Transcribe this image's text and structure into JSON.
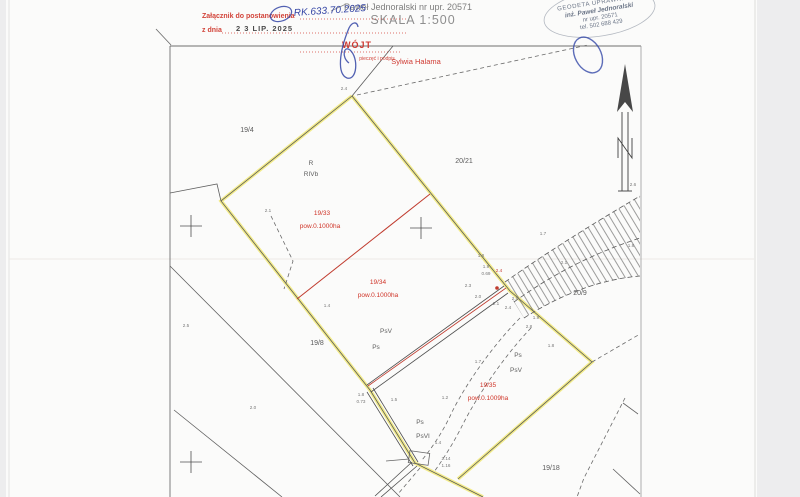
{
  "header": {
    "surveyor_line": "Paweł Jednoralski nr upr. 20571",
    "scale": "SKALA 1:500"
  },
  "attachment_stamp": {
    "line1": "Załącznik do postanowienia",
    "case_number": "RK.633.70.2025",
    "date_label": "z dnia",
    "date_stamp": "2 3  LIP. 2025",
    "caption": "pieczęć i podpis"
  },
  "mayor_stamp": {
    "title": "WÓJT",
    "name": "Sylwia Halama"
  },
  "surveyor_stamp": {
    "line1": "GEODETA UPRAWNIONY",
    "line2": "inż. Paweł Jednoralski",
    "line3": "nr upr.  20571",
    "line4": "tel. 502 688 429"
  },
  "colors": {
    "boundary_highlight": "#f1e97c",
    "split_line_red": "#c03b2e",
    "stamp_red": "#d2443a",
    "pen_blue": "#3445a5",
    "surveyor_stamp_gray": "#6b7587"
  },
  "map": {
    "parcel_labels": [
      {
        "t": "19/4",
        "x": 247,
        "y": 132
      },
      {
        "t": "20/21",
        "x": 464,
        "y": 163
      },
      {
        "t": "20/9",
        "x": 580,
        "y": 295
      },
      {
        "t": "19/8",
        "x": 317,
        "y": 345
      },
      {
        "t": "19/18",
        "x": 551,
        "y": 470
      }
    ],
    "surface_labels": [
      {
        "t": "R",
        "x": 311,
        "y": 165
      },
      {
        "t": "RIVb",
        "x": 311,
        "y": 176
      },
      {
        "t": "PsV",
        "x": 386,
        "y": 333
      },
      {
        "t": "Ps",
        "x": 376,
        "y": 349
      },
      {
        "t": "Ps",
        "x": 518,
        "y": 357
      },
      {
        "t": "PsV",
        "x": 516,
        "y": 372
      },
      {
        "t": "Ps",
        "x": 420,
        "y": 424
      },
      {
        "t": "PsVI",
        "x": 423,
        "y": 438
      }
    ],
    "area_labels": [
      {
        "t": "19/33",
        "x": 322,
        "y": 215
      },
      {
        "t": "pow.0.1000ha",
        "x": 320,
        "y": 228
      },
      {
        "t": "19/34",
        "x": 378,
        "y": 284
      },
      {
        "t": "pow.0.1000ha",
        "x": 378,
        "y": 297
      },
      {
        "t": "19/35",
        "x": 488,
        "y": 387
      },
      {
        "t": "pow.0.1009ha",
        "x": 488,
        "y": 400
      }
    ],
    "point_labels": [
      {
        "t": "2.4",
        "x": 344,
        "y": 90
      },
      {
        "t": "2.1",
        "x": 268,
        "y": 212
      },
      {
        "t": "1.4",
        "x": 327,
        "y": 307
      },
      {
        "t": "2.5",
        "x": 186,
        "y": 327
      },
      {
        "t": "2.0",
        "x": 253,
        "y": 409
      },
      {
        "t": "1.8",
        "x": 481,
        "y": 257
      },
      {
        "t": "1.7",
        "x": 543,
        "y": 235
      },
      {
        "t": "2.1",
        "x": 564,
        "y": 264
      },
      {
        "t": "2.6",
        "x": 633,
        "y": 186
      },
      {
        "t": "1.8",
        "x": 631,
        "y": 247
      },
      {
        "t": "1.9",
        "x": 486,
        "y": 268
      },
      {
        "t": "0.69",
        "x": 486,
        "y": 275
      },
      {
        "t": "2.4",
        "x": 499,
        "y": 272,
        "cls": "red"
      },
      {
        "t": "2.3",
        "x": 468,
        "y": 287
      },
      {
        "t": "2.0",
        "x": 478,
        "y": 298
      },
      {
        "t": "2.1",
        "x": 496,
        "y": 305
      },
      {
        "t": "2.5",
        "x": 515,
        "y": 300
      },
      {
        "t": "2.4",
        "x": 508,
        "y": 309
      },
      {
        "t": "1.9",
        "x": 536,
        "y": 319
      },
      {
        "t": "2.8",
        "x": 529,
        "y": 328
      },
      {
        "t": "1.8",
        "x": 551,
        "y": 347
      },
      {
        "t": "1.7",
        "x": 478,
        "y": 363
      },
      {
        "t": "1.2",
        "x": 445,
        "y": 399
      },
      {
        "t": "1.8",
        "x": 361,
        "y": 396
      },
      {
        "t": "0.73",
        "x": 361,
        "y": 403
      },
      {
        "t": "1.5",
        "x": 394,
        "y": 401
      },
      {
        "t": "1.4",
        "x": 438,
        "y": 444
      },
      {
        "t": "2.14",
        "x": 446,
        "y": 460
      },
      {
        "t": "1.16",
        "x": 446,
        "y": 467
      }
    ]
  }
}
